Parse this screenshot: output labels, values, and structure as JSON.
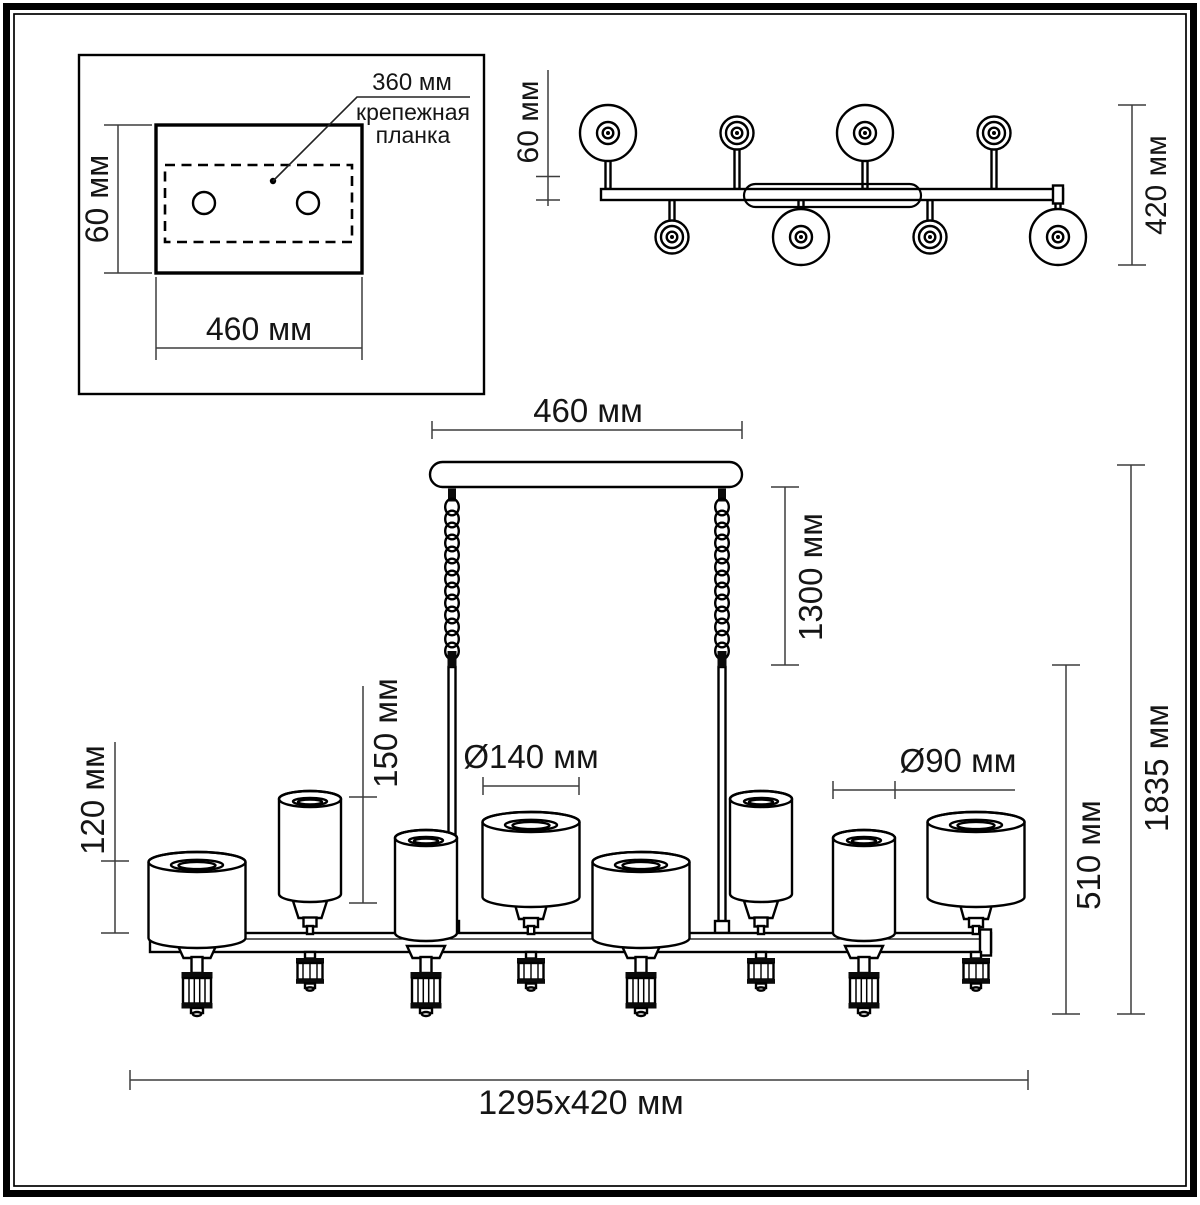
{
  "title": "chandelier-dimension-drawing",
  "inset": {
    "leader_value": "360 мм",
    "leader_label_line1": "крепежная",
    "leader_label_line2": "планка",
    "height": "60 мм",
    "width": "460 мм"
  },
  "top_view": {
    "bar_thickness": "60 мм",
    "overall_depth": "420 мм"
  },
  "front_view": {
    "canopy_width": "460 мм",
    "suspension_length": "1300 мм",
    "small_shade_height": "150 мм",
    "large_shade_height": "120 мм",
    "large_shade_diameter": "Ø140 мм",
    "small_shade_diameter": "Ø90 мм",
    "body_height": "510 мм",
    "overall_height": "1835 мм",
    "overall_size": "1295x420 мм"
  },
  "colors": {
    "line": "#000000",
    "dimension": "#3d3d3d",
    "background": "#ffffff"
  }
}
